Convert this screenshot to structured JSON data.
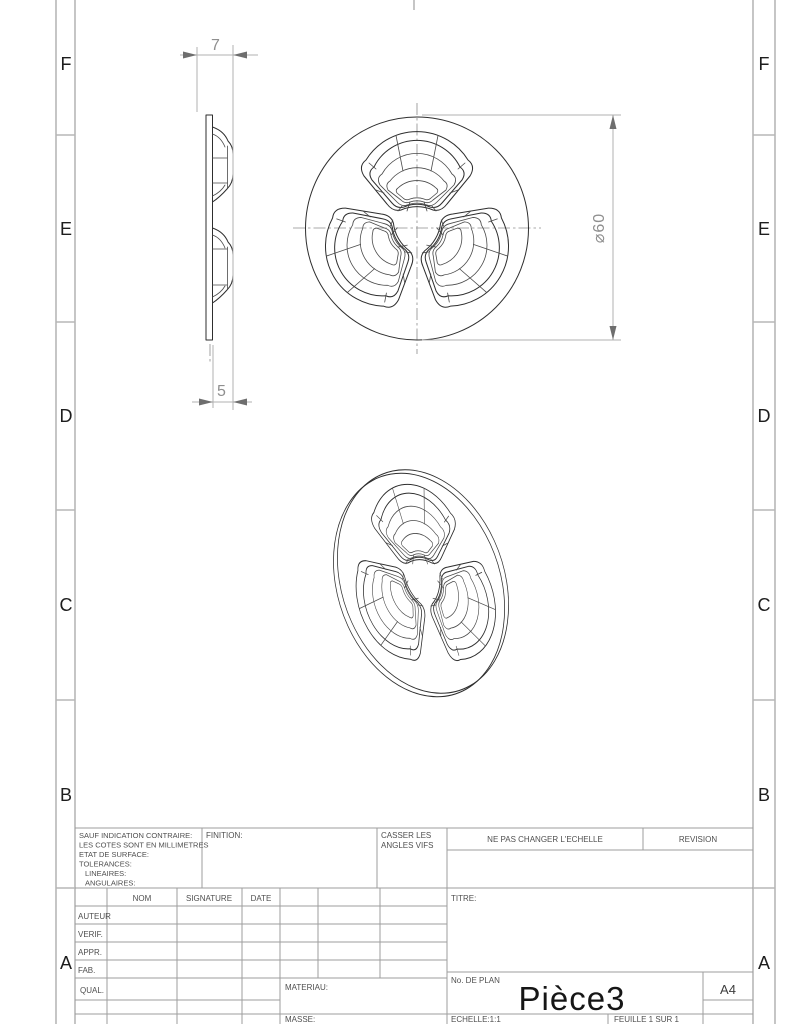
{
  "zones": {
    "letters": [
      "F",
      "E",
      "D",
      "C",
      "B",
      "A"
    ]
  },
  "dimensions": {
    "width_top": "7",
    "width_bottom": "5",
    "diameter": "⌀60"
  },
  "title_block": {
    "notes": [
      "SAUF INDICATION CONTRAIRE:",
      "LES COTES SONT EN MILLIMETRES",
      "ETAT DE SURFACE:",
      "TOLERANCES:",
      "LINEAIRES:",
      "ANGULAIRES:"
    ],
    "finition_label": "FINITION:",
    "deburr": [
      "CASSER LES",
      "ANGLES VIFS"
    ],
    "no_scale_note": "NE PAS CHANGER L'ECHELLE",
    "revision_label": "REVISION",
    "columns": {
      "nom": "NOM",
      "signature": "SIGNATURE",
      "date": "DATE"
    },
    "rows": [
      "AUTEUR",
      "VERIF.",
      "APPR.",
      "FAB.",
      "QUAL."
    ],
    "materiau_label": "MATERIAU:",
    "masse_label": "MASSE:",
    "titre_label": "TITRE:",
    "plan_label": "No. DE PLAN",
    "part_name": "Pièce3",
    "sheet_format": "A4",
    "echelle_label": "ECHELLE:1:1",
    "feuille_label": "FEUILLE 1 SUR 1"
  }
}
